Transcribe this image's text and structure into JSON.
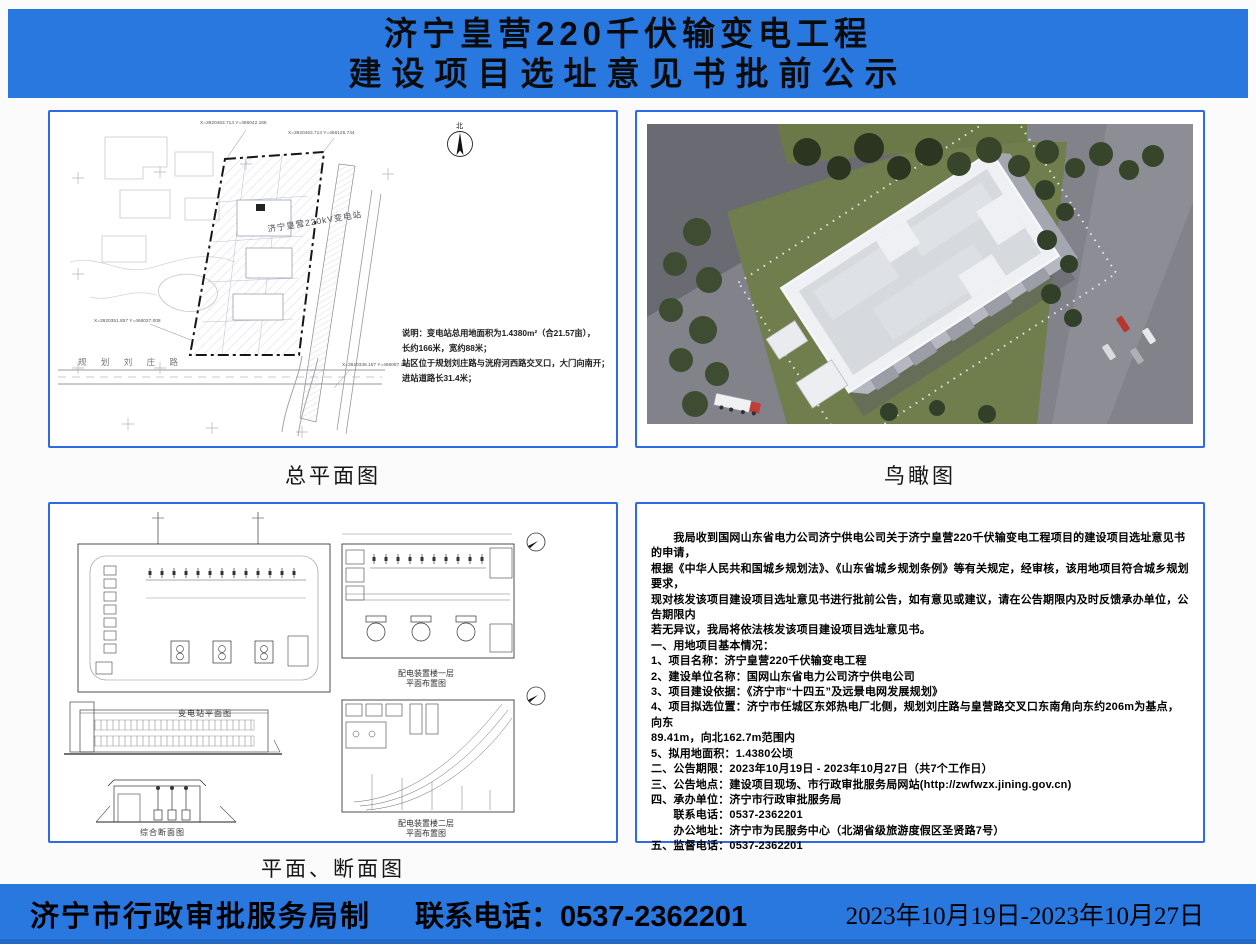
{
  "header": {
    "title_line1": "济宁皇营220千伏输变电工程",
    "title_line2": "建设项目选址意见书批前公示"
  },
  "site_plan": {
    "caption": "总平面图",
    "station_label": "济宁皇营220kV变电站",
    "north_label": "北",
    "road_label": "规 划 刘 庄 路",
    "note_line1": "说明：变电站总用地面积为1.4380m²（合21.57亩），",
    "note_line2": "长约166米，宽约88米；",
    "note_line3": "站区位于规划刘庄路与洸府河西路交叉口，大门向南开；",
    "note_line4": "进站道路长31.4米；",
    "coord_label1": "X=3920463.714 Y=466042.166",
    "coord_label2": "X=3920463.714 Y=466125.744",
    "coord_label3": "X=3920351.857 Y=466037.008",
    "coord_label4": "X=3920339.157 Y=466087.201"
  },
  "aerial": {
    "caption": "鸟瞰图"
  },
  "plans": {
    "caption": "平面、断面图",
    "station_plan_caption": "变电站平面图",
    "floor1_caption_line1": "配电装置楼一层",
    "floor1_caption_line2": "平面布置图",
    "section_caption": "综合断面图",
    "floor2_caption_line1": "配电装置楼二层",
    "floor2_caption_line2": "平面布置图"
  },
  "notice": {
    "lines": [
      "　　我局收到国网山东省电力公司济宁供电公司关于济宁皇营220千伏输变电工程项目的建设项目选址意见书的申请，",
      "根据《中华人民共和国城乡规划法》、《山东省城乡规划条例》等有关规定，经审核，该用地项目符合城乡规划要求，",
      "现对核发该项目建设项目选址意见书进行批前公告，如有意见或建议，请在公告期限内及时反馈承办单位，公告期限内",
      "若无异议，我局将依法核发该项目建设项目选址意见书。",
      "一、用地项目基本情况：",
      "1、项目名称：济宁皇营220千伏输变电工程",
      "2、建设单位名称：国网山东省电力公司济宁供电公司",
      "3、项目建设依据：《济宁市“十四五”及远景电网发展规划》",
      "4、项目拟选位置：济宁市任城区东郊热电厂北侧，规划刘庄路与皇营路交叉口东南角向东约206m为基点，向东",
      "89.41m，向北162.7m范围内",
      "5、拟用地面积：1.4380公顷",
      "二、公告期限：2023年10月19日 - 2023年10月27日（共7个工作日）",
      "三、公告地点：建设项目现场、市行政审批服务局网站(http://zwfwzx.jining.gov.cn)",
      "四、承办单位：济宁市行政审批服务局",
      "　　联系电话：0537-2362201",
      "　　办公地址：济宁市为民服务中心（北湖省级旅游度假区圣贤路7号）",
      "五、监督电话：0537-2362201"
    ]
  },
  "footer": {
    "issuer": "济宁市行政审批服务局制",
    "phone": "联系电话：0537-2362201",
    "date_range": "2023年10月19日-2023年10月27日"
  },
  "colors": {
    "banner_blue": "#2878df",
    "panel_border_blue": "#2e6be2"
  }
}
